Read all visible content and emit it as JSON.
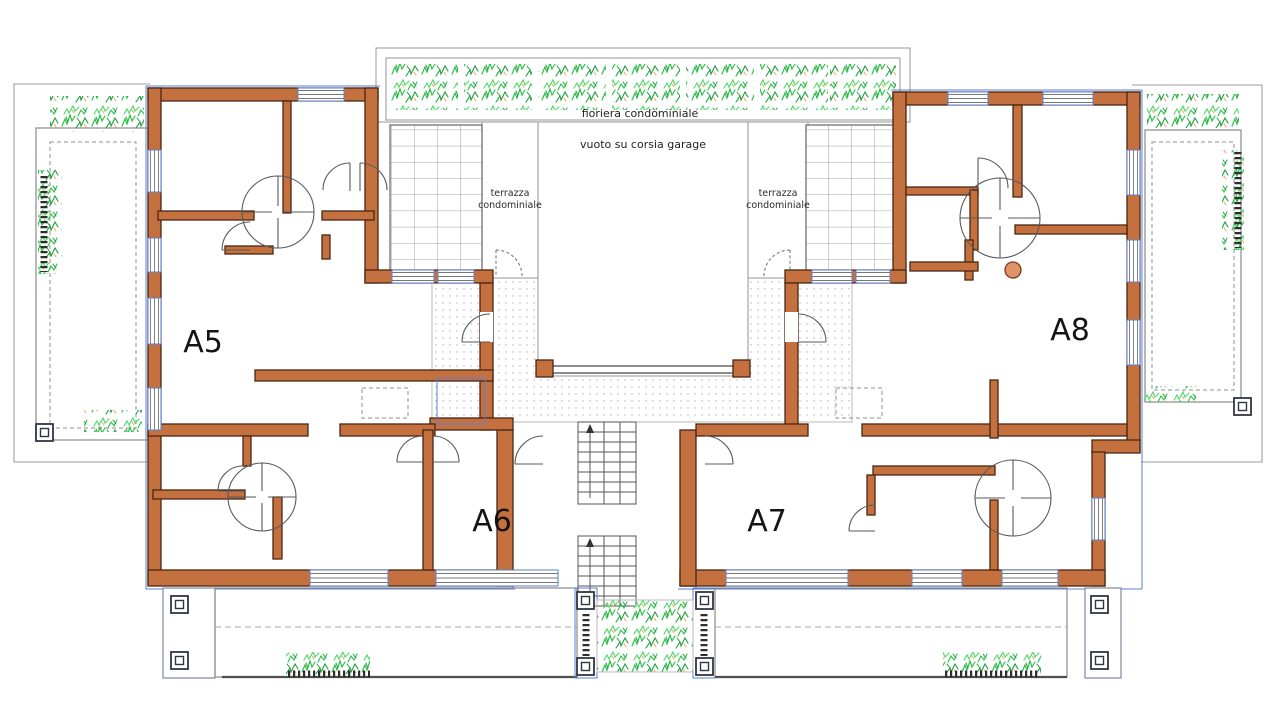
{
  "plan_title": "residential floor plan",
  "units": [
    {
      "label": "A5"
    },
    {
      "label": "A6"
    },
    {
      "label": "A7"
    },
    {
      "label": "A8"
    }
  ],
  "labels": {
    "fioriera": "fioriera condominiale",
    "vuoto": "vuoto su corsia garage",
    "terrazza_line1": "terrazza",
    "terrazza_line2": "condominiale"
  },
  "colors": {
    "wall": "#C4713F",
    "wall-outline": "#4A2513",
    "accent-blue": "#5B7FD0",
    "plant-green": "#2EBF4A",
    "plant-green-dark": "#1E9E3C",
    "plant-green-light": "#57D96E",
    "twig-orange": "#E9A75C",
    "deck-tan": "#C79A6D",
    "stair-line": "#555555",
    "boundary-gray": "#9E9E9E",
    "column-circle": "#DE9368"
  }
}
